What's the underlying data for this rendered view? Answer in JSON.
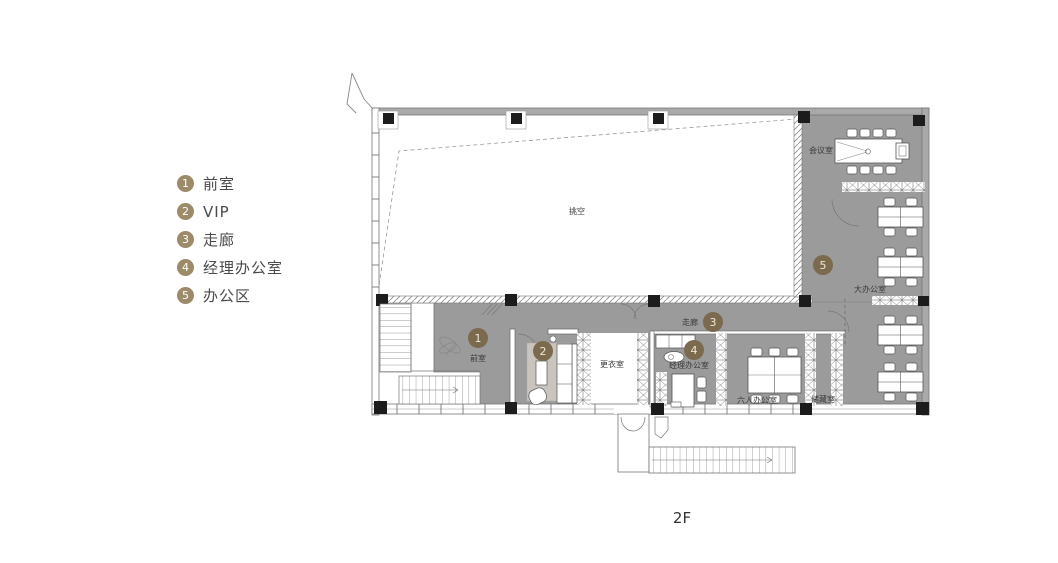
{
  "palette": {
    "floor_gray": "#9b9b9b",
    "wall_line": "#707070",
    "legend_circle": "#9c8a68",
    "plan_marker": "#7b6a4d",
    "floor_tag_color": "#997e5f",
    "legend_text": "#4a4a4a"
  },
  "legend": {
    "items": [
      {
        "num": "1",
        "label": "前室"
      },
      {
        "num": "2",
        "label": "VIP"
      },
      {
        "num": "3",
        "label": "走廊"
      },
      {
        "num": "4",
        "label": "经理办公室"
      },
      {
        "num": "5",
        "label": "办公区"
      }
    ]
  },
  "plan": {
    "floor_label": "2F",
    "room_labels": {
      "void": "挑空",
      "meeting_room": "会议室",
      "large_office": "大办公室",
      "corridor": "走廊",
      "front_room": "前室",
      "changing_room": "更衣室",
      "manager_office": "经理办公室",
      "six_person_office": "六人办公室",
      "storage": "储藏室"
    },
    "markers": [
      {
        "num": "1"
      },
      {
        "num": "2"
      },
      {
        "num": "3"
      },
      {
        "num": "4"
      },
      {
        "num": "5"
      }
    ]
  }
}
